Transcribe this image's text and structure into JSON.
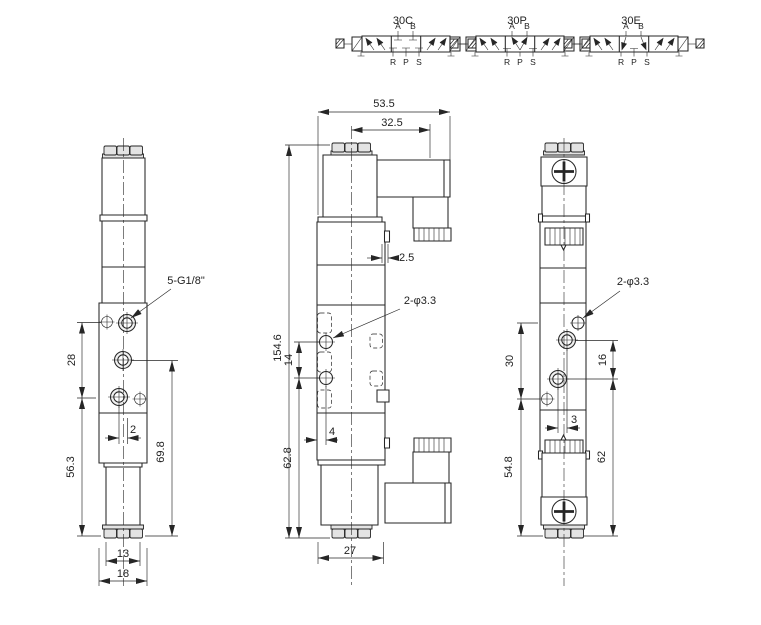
{
  "page": {
    "background": "#ffffff",
    "line_color": "#262626"
  },
  "symbols": [
    {
      "label": "30C",
      "port_a": "A",
      "port_b": "B",
      "port_r": "R",
      "port_p": "P",
      "port_s": "S"
    },
    {
      "label": "30P",
      "port_a": "A",
      "port_b": "B",
      "port_r": "R",
      "port_p": "P",
      "port_s": "S"
    },
    {
      "label": "30E",
      "port_a": "A",
      "port_b": "B",
      "port_r": "R",
      "port_p": "P",
      "port_s": "S"
    }
  ],
  "front_view": {
    "thread_label": "5-G1/8\"",
    "dim_port_span": "28",
    "dim_port_offset": "2",
    "dim_lower_span": "56.3",
    "dim_side_span": "69.8",
    "dim_coil_width": "13",
    "dim_body_width": "18"
  },
  "side_view": {
    "dim_total_width": "53.5",
    "dim_connector_offset": "32.5",
    "dim_override_offset": "2.5",
    "mount_hole_label": "2-φ3.3",
    "dim_total_height": "154.6",
    "dim_hole_span": "14",
    "dim_hole_inset": "4",
    "dim_lower_span": "62.8",
    "dim_body_depth": "27"
  },
  "back_view": {
    "mount_hole_label": "2-φ3.3",
    "dim_upper_span": "30",
    "dim_port_span": "16",
    "dim_port_offset": "3",
    "dim_lower_span": "54.8",
    "dim_side_span": "62"
  }
}
